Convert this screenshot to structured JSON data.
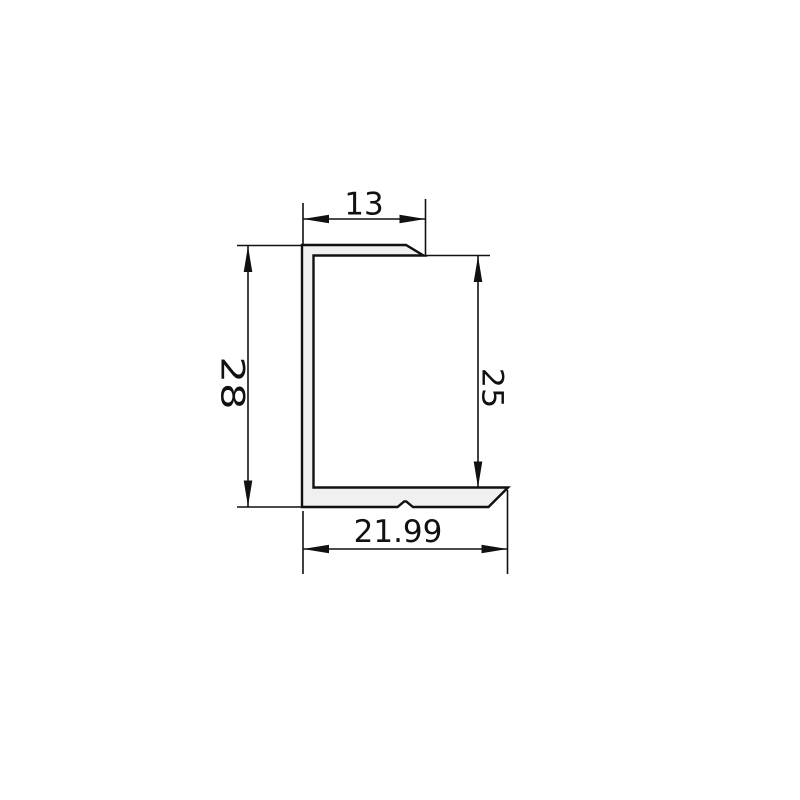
{
  "drawing": {
    "type": "profile-cross-section-drawing",
    "background_color": "#ffffff",
    "line_color": "#111111",
    "profile_fill_color": "#f0f0f0",
    "dimensions": {
      "top_width": {
        "label": "13"
      },
      "overall_height": {
        "label": "28"
      },
      "inner_height": {
        "label": "25"
      },
      "bottom_width": {
        "label": "21.99"
      }
    }
  }
}
